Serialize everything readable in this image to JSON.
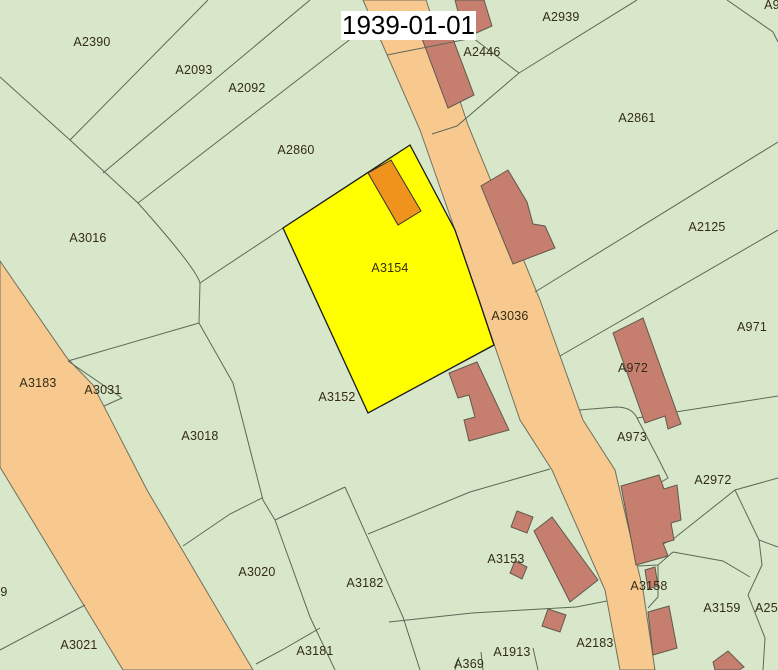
{
  "title": {
    "date": "1939-01-01"
  },
  "colors": {
    "background": "#d8e7ca",
    "road": "#f8c98f",
    "building": "#c67f6e",
    "parcel_highlight": "#ffff00",
    "building_highlight": "#f0931d"
  },
  "labels": [
    {
      "text": "A2390",
      "x": 92,
      "y": 42
    },
    {
      "text": "A2093",
      "x": 194,
      "y": 70
    },
    {
      "text": "A2092",
      "x": 247,
      "y": 88
    },
    {
      "text": "A2860",
      "x": 296,
      "y": 150
    },
    {
      "text": "A2939",
      "x": 561,
      "y": 17
    },
    {
      "text": "A2446",
      "x": 482,
      "y": 52
    },
    {
      "text": "A2861",
      "x": 637,
      "y": 118
    },
    {
      "text": "A2125",
      "x": 707,
      "y": 227
    },
    {
      "text": "A9",
      "x": 772,
      "y": 5
    },
    {
      "text": "A3016",
      "x": 88,
      "y": 238
    },
    {
      "text": "A3154",
      "x": 390,
      "y": 268
    },
    {
      "text": "A3036",
      "x": 510,
      "y": 316
    },
    {
      "text": "A971",
      "x": 752,
      "y": 327
    },
    {
      "text": "A972",
      "x": 633,
      "y": 368
    },
    {
      "text": "A3183",
      "x": 38,
      "y": 383
    },
    {
      "text": "A3031",
      "x": 103,
      "y": 390
    },
    {
      "text": "A3152",
      "x": 337,
      "y": 397
    },
    {
      "text": "A3018",
      "x": 200,
      "y": 436
    },
    {
      "text": "A973",
      "x": 632,
      "y": 437
    },
    {
      "text": "A2972",
      "x": 713,
      "y": 480
    },
    {
      "text": "A3153",
      "x": 506,
      "y": 559
    },
    {
      "text": "A3020",
      "x": 257,
      "y": 572
    },
    {
      "text": "A3182",
      "x": 365,
      "y": 583
    },
    {
      "text": "A3158",
      "x": 649,
      "y": 586
    },
    {
      "text": "A3159",
      "x": 722,
      "y": 608
    },
    {
      "text": "A256",
      "x": 770,
      "y": 608
    },
    {
      "text": "A2183",
      "x": 595,
      "y": 643
    },
    {
      "text": "A3021",
      "x": 79,
      "y": 645
    },
    {
      "text": "A1913",
      "x": 512,
      "y": 652
    },
    {
      "text": "A3181",
      "x": 315,
      "y": 651
    },
    {
      "text": "A369",
      "x": 469,
      "y": 664
    },
    {
      "text": "9",
      "x": 4,
      "y": 592
    }
  ]
}
